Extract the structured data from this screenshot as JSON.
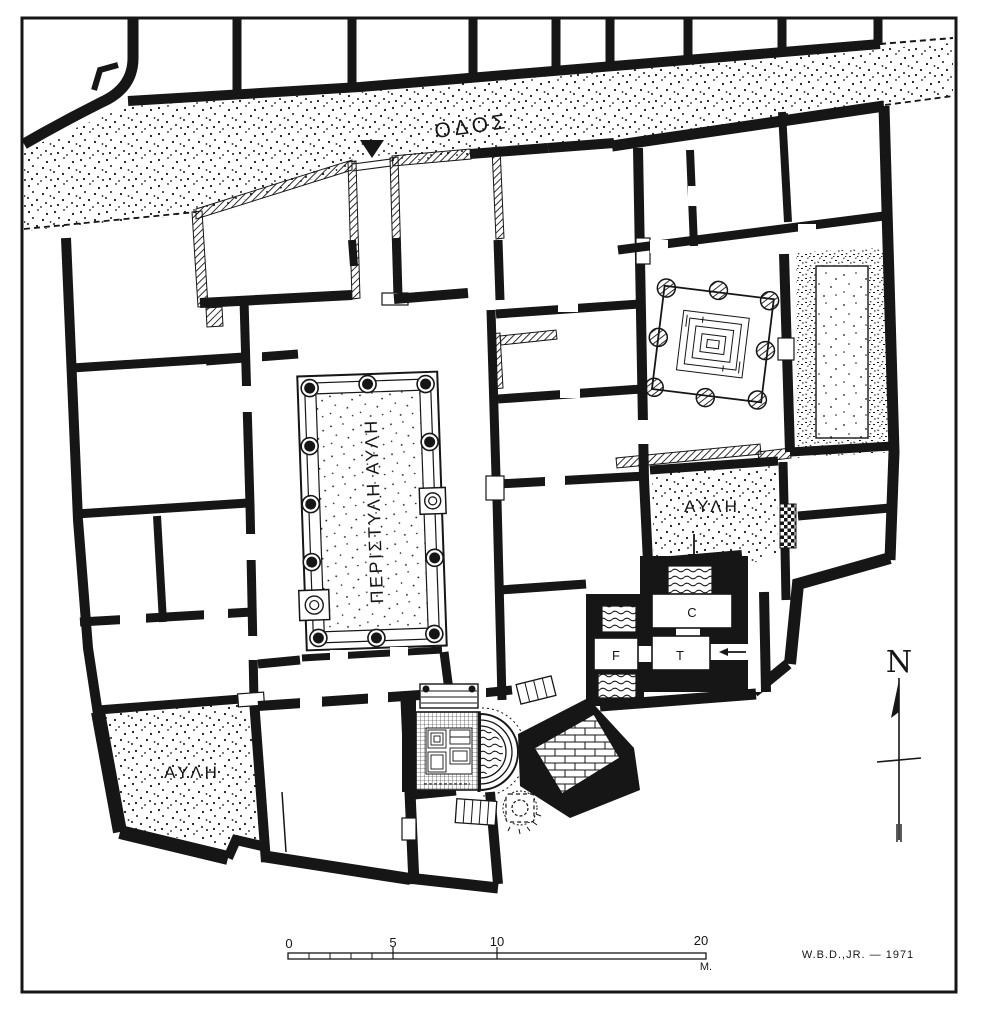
{
  "meta": {
    "drawing_type": "archaeological floor plan (Greek house with bath suite)",
    "paper_color": "#ffffff",
    "ink_color": "#161616"
  },
  "labels": {
    "street": "ΟΔΟΣ",
    "peristyle_court": "ΠΕΡΙΣΤΥΛΗ ΑΥΛΗ",
    "court_right": "ΑΥΛΗ",
    "court_left": "ΑΥΛΗ",
    "room_c": "C",
    "room_f": "F",
    "room_t": "T",
    "north": "N"
  },
  "scale_bar": {
    "ticks": [
      "0",
      "5",
      "10",
      "20"
    ],
    "unit": "M."
  },
  "signature": "W.B.D.,JR. — 1971"
}
